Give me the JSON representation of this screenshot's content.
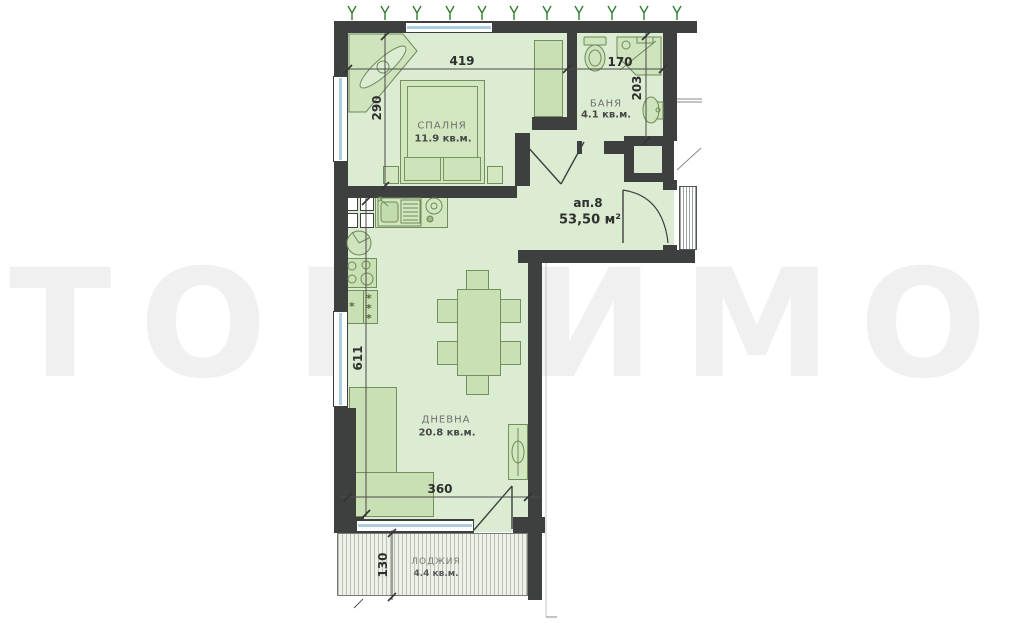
{
  "watermark": "ТОП ИМО",
  "apartment": {
    "label": "ап.8",
    "area": "53,50 м²"
  },
  "rooms": {
    "bedroom": {
      "name": "СПАЛНЯ",
      "area": "11.9 кв.м."
    },
    "bathroom": {
      "name": "БАНЯ",
      "area": "4.1 кв.м."
    },
    "living": {
      "name": "ДНЕВНА",
      "area": "20.8 кв.м."
    },
    "loggia": {
      "name": "ЛОДЖИЯ",
      "area": "4.4 кв.м."
    }
  },
  "dimensions": {
    "bedroom_width": "419",
    "bedroom_height": "290",
    "bathroom_width": "170",
    "bathroom_height": "203",
    "living_height": "611",
    "living_width": "360",
    "loggia_height": "130"
  },
  "symbols": {
    "freezer_star": "*"
  },
  "colors": {
    "wall": "#3e403f",
    "room_fill": "#dcecd2",
    "furniture": "#c9e0b4",
    "window_glass": "#aecde2",
    "vegetation": "#2e7d32",
    "watermark": "#f0f0f0",
    "dimension_text": "#2e2e2e"
  }
}
